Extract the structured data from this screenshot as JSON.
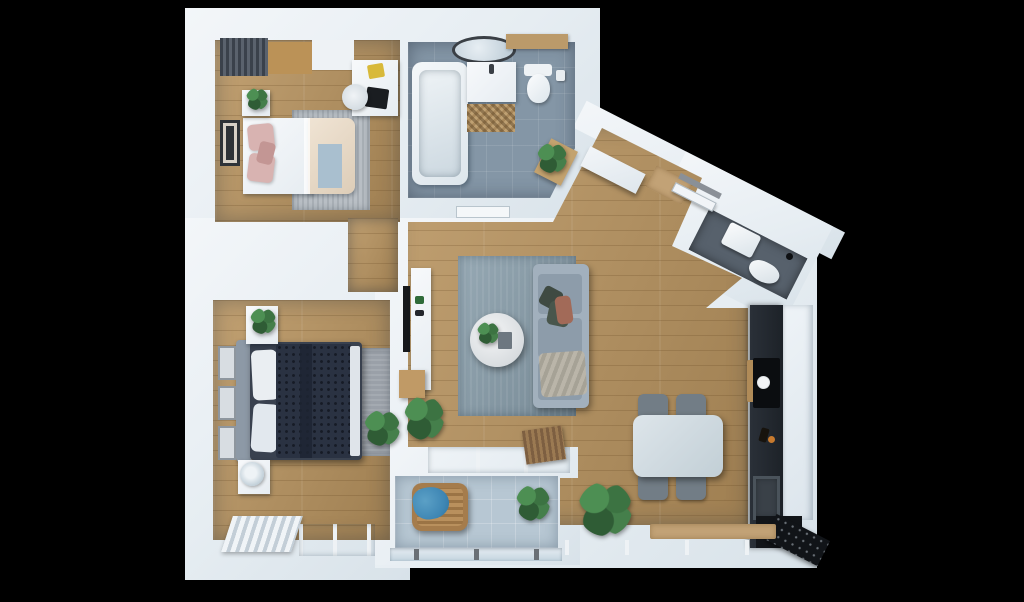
{
  "canvas": {
    "width": 1024,
    "height": 602
  },
  "scene": {
    "title": "apartment-floor-plan-3d-top-view",
    "style": "photoreal 3D architectural render, top-down, on black background",
    "background": "#000000"
  },
  "palette": {
    "bg": "#000000",
    "wall": "#e9eef3",
    "wood": "#b9945f",
    "bathTile": "#8496a6",
    "balconyTile": "#b7c7d3",
    "wcFloor": "#57616c",
    "rug": "#8da1ad",
    "sofa": "#a2b0bd",
    "sofaSeat": "#8d9caa",
    "navy": "#2a3242",
    "table": "#ccd7dd",
    "chair": "#727d86",
    "counter": "#22272e",
    "appliance": "#121519",
    "glass": "#cfe0ea",
    "tan": "#c2a276",
    "wicker": "#b9905d",
    "blanketBlue": "#3e86b4",
    "pink": "#d8b3b1",
    "beige": "#e9dccb",
    "throwBlue": "#a9bfcf",
    "plantGreen": "#3c7342",
    "frameDark": "#2e3338"
  },
  "rooms": [
    {
      "name": "bedroom-1",
      "position": "top-left",
      "floor": "wood",
      "furniture": [
        "wardrobe-slatted",
        "double-bed-white-pink",
        "gray-area-rug",
        "nightstand",
        "potted-plant",
        "desk",
        "laptop",
        "yellow-book",
        "desk-chair",
        "wall-art"
      ]
    },
    {
      "name": "bathroom",
      "position": "top-center",
      "floor": "blue-gray-tile",
      "furniture": [
        "bathtub",
        "vanity-sink",
        "round-mirror",
        "woven-mat",
        "toilet",
        "toilet-paper-holder",
        "wood-shelf",
        "stool-with-plant"
      ]
    },
    {
      "name": "entry-hall",
      "position": "top-right-diagonal",
      "floor": "wood",
      "furniture": [
        "sideboard",
        "doormat",
        "front-door"
      ]
    },
    {
      "name": "wc",
      "position": "right-diagonal",
      "floor": "dark-gray-tile",
      "furniture": [
        "wash-basin",
        "toilet"
      ]
    },
    {
      "name": "living-room",
      "position": "center",
      "floor": "wood",
      "furniture": [
        "sofa-gray",
        "throw-pillows",
        "blanket",
        "round-coffee-table",
        "blue-gray-rug",
        "tv",
        "tv-console",
        "wood-cabinet",
        "potted-plants",
        "magazine-stack-on-half-wall"
      ]
    },
    {
      "name": "dining-area",
      "position": "center-right",
      "floor": "wood",
      "furniture": [
        "dining-table-white",
        "chair",
        "chair",
        "chair",
        "chair"
      ]
    },
    {
      "name": "kitchen",
      "position": "right-wall",
      "floor": "wood",
      "furniture": [
        "dark-counter",
        "cooktop",
        "cutting-board",
        "kitchen-sink",
        "tall-cabinets",
        "fridge-black"
      ]
    },
    {
      "name": "bedroom-2",
      "position": "bottom-left",
      "floor": "wood",
      "furniture": [
        "double-bed-navy-quilted",
        "headboard",
        "white-pillows",
        "nightstand-with-plant",
        "nightstand-with-lamp",
        "gray-area-rug",
        "wall-frames-x3",
        "radiator",
        "window",
        "potted-plant"
      ]
    },
    {
      "name": "balcony",
      "position": "bottom-center",
      "floor": "light-blue-tile",
      "furniture": [
        "wicker-chair",
        "blue-blanket",
        "potted-plant",
        "glass-railing"
      ]
    },
    {
      "name": "storage-niche",
      "position": "between-bedrooms",
      "floor": "wood",
      "furniture": []
    }
  ]
}
